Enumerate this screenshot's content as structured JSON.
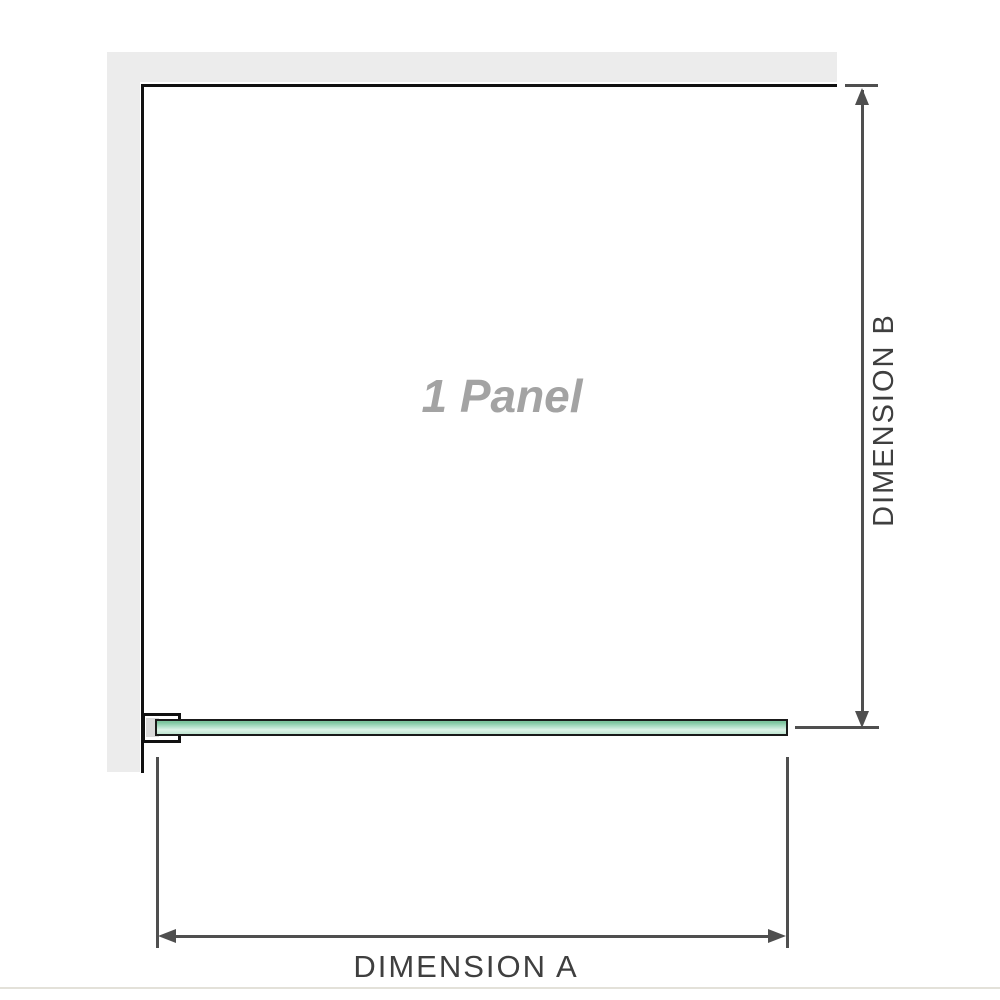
{
  "diagram": {
    "panel_label": "1 Panel",
    "dimensions": {
      "a_label": "DIMENSION A",
      "b_label": "DIMENSION B"
    },
    "colors": {
      "wall": "#ececec",
      "panel_outline": "#111111",
      "dimension_line": "#4f4f4f",
      "dimension_text": "#3f3f3f",
      "panel_text": "#a3a3a3",
      "glass_green_top": "#7cc49e",
      "glass_green_light": "#ddf2e7",
      "glass_green_bottom": "#bfe5d1",
      "glass_border": "#1a1a1a",
      "clamp_inner": "#d9d9d9",
      "footer_rule": "#e3e1d9"
    }
  }
}
